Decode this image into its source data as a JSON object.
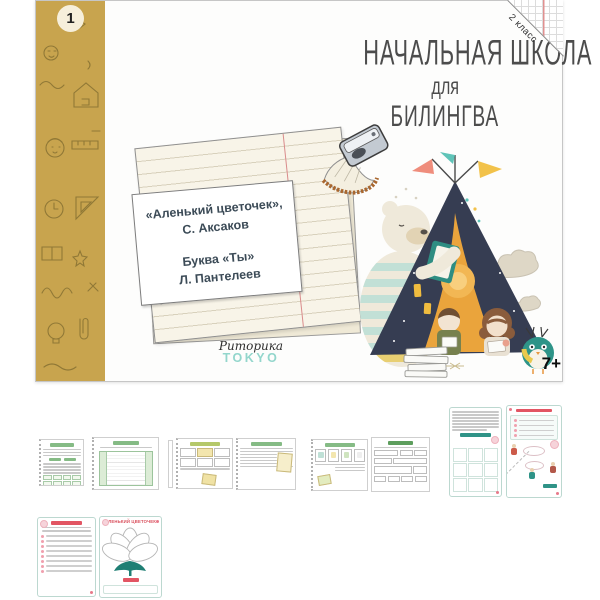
{
  "page": {
    "background": "#ffffff"
  },
  "cover": {
    "volume_badge": "1",
    "grade_tag": "2 класс",
    "title": {
      "line1": "НАЧАЛЬНАЯ ШКОЛА",
      "line2": "для",
      "line3": "БИЛИНГВА"
    },
    "works_card": {
      "line1": "«Аленький цветочек»,",
      "line2": "С. Аксаков",
      "line3": "Буква «Ты»",
      "line4": "Л. Пантелеев"
    },
    "publisher": {
      "script": "Риторика",
      "brand": "TOKYO"
    },
    "age_rating": "7+",
    "illustration_icons": [
      "doodle-pattern-icon",
      "pencil-sharpener-icon",
      "pencil-shaving-icon",
      "notepad-icon",
      "teepee-tent-icon",
      "polar-bear-reading-icon",
      "boy-reading-icon",
      "girl-reading-icon",
      "owl-icon",
      "clouds-icon",
      "flags-icon",
      "book-stack-icon",
      "grade-corner-fold-icon"
    ],
    "colors": {
      "spine_gold": "#c8a44e",
      "doodle_brown": "#8a7434",
      "tent_navy": "#363d52",
      "tent_orange": "#eaa43c",
      "accent_teal": "#5fc4b8",
      "accent_coral": "#ef8d7c",
      "accent_yellow": "#f2c24a",
      "logo_teal": "#93d6cc"
    }
  },
  "thumbnails": {
    "flower_page_title": "АЛЕНЬКИЙ ЦВЕТОЧЕК",
    "accent_green": "#85bb85",
    "accent_red": "#e25563",
    "accent_mint": "#bcd8d0",
    "row1": [
      {
        "name": "worksheet-spread-text-columns-green"
      },
      {
        "name": "worksheet-spread-cards-and-notes"
      },
      {
        "name": "worksheet-spread-task-cards-form"
      },
      {
        "name": "worksheet-spread-grid-and-characters"
      }
    ],
    "row2": [
      {
        "name": "worksheet-spread-checklist-and-flower"
      }
    ]
  }
}
